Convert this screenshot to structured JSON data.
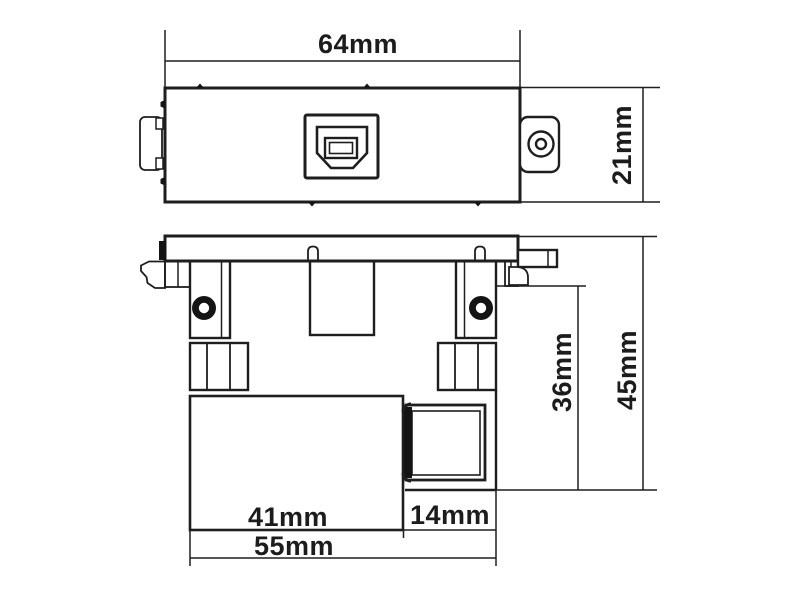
{
  "drawing": {
    "kind": "technical-dimension-drawing",
    "subject": "usb-type-b-wall-plate-module",
    "line_color": "#1e1e1e",
    "background_color": "#ffffff",
    "views": [
      {
        "id": "top-view",
        "role": "front-face-view-with-usb-b-port"
      },
      {
        "id": "side-view",
        "role": "side-profile-view-with-mounting-clips"
      }
    ],
    "dims": {
      "top_width": "64mm",
      "top_height": "21mm",
      "body_height": "36mm",
      "total_height": "45mm",
      "body_width": "41mm",
      "connector_width": "14mm",
      "total_width": "55mm"
    }
  }
}
